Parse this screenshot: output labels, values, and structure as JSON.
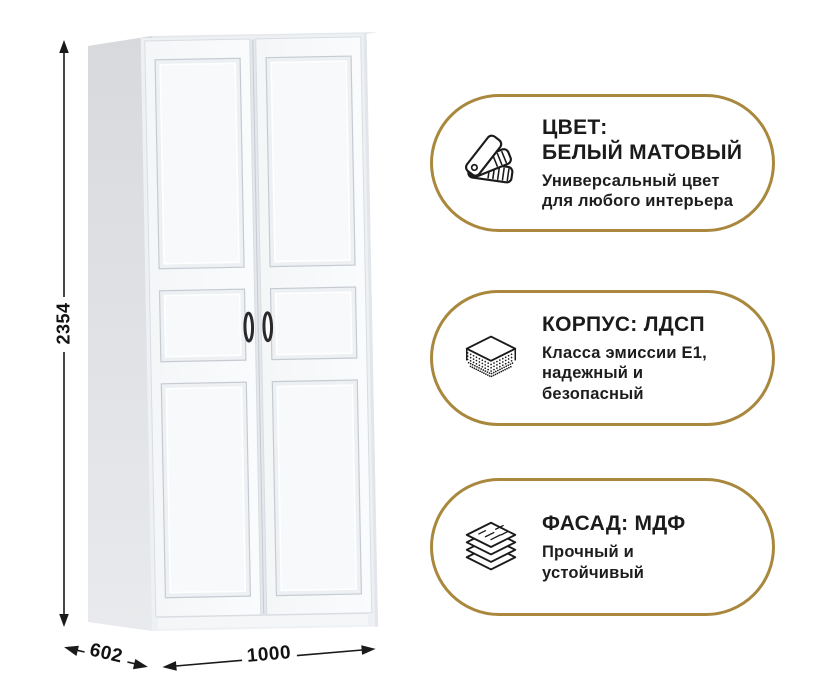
{
  "canvas": {
    "width": 816,
    "height": 700,
    "background": "#ffffff"
  },
  "colors": {
    "badge_border": "#a9883d",
    "badge_background": "#ffffff",
    "title_text": "#1b1b1b",
    "subtitle_text": "#1d1d1d",
    "dimension_text": "#121212",
    "dimension_line": "#1a1a1a",
    "icon_stroke": "#1a1a1a",
    "wardrobe_front": "#f5f7f9",
    "wardrobe_side": "#d8dadd",
    "panel_groove": "#c6cbd2",
    "handle": "#2a2a2e"
  },
  "wardrobe": {
    "type": "two-door wardrobe illustration",
    "dimensions": {
      "height": "2354",
      "depth": "602",
      "width": "1000"
    }
  },
  "badges": [
    {
      "id": "color",
      "icon": "color-swatch-fan-icon",
      "title_lines": [
        "ЦВЕТ:",
        "БЕЛЫЙ МАТОВЫЙ"
      ],
      "subtitle_lines": [
        "Универсальный цвет",
        "для любого интерьера"
      ]
    },
    {
      "id": "body",
      "icon": "chipboard-layers-icon",
      "title_lines": [
        "КОРПУС: ЛДСП"
      ],
      "subtitle_lines": [
        "Класса эмиссии Е1,",
        "надежный и",
        "безопасный"
      ]
    },
    {
      "id": "facade",
      "icon": "mdf-stack-icon",
      "title_lines": [
        "ФАСАД: МДФ"
      ],
      "subtitle_lines": [
        "Прочный и",
        "устойчивый"
      ]
    }
  ]
}
